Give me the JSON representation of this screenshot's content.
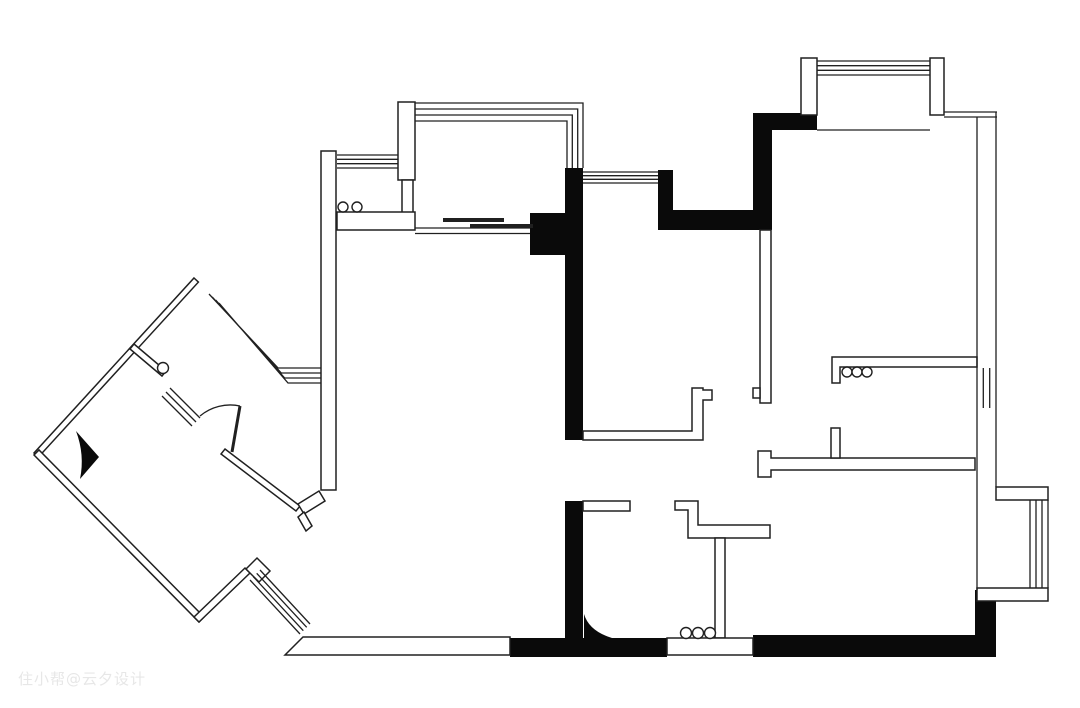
{
  "page": {
    "title": "apartment-floor-plan",
    "width": 1080,
    "height": 708,
    "background": "#ffffff"
  },
  "watermark": {
    "text": "住小帮@云夕设计",
    "color": "#e7e7e7"
  },
  "plan": {
    "stroke": "#202020",
    "fill_black": "#0a0a0a",
    "white": "#ffffff",
    "elements": [
      {
        "name": "black-wall-kitchen-column",
        "kind": "black",
        "d": "M565,168 H583 V440 H565 Z M530,213 H565 V255 H530 Z"
      },
      {
        "name": "black-wall-top-center",
        "kind": "black",
        "d": "M658,170 H673 V210 H753 V113 H817 V130 H772 V230 H658 Z"
      },
      {
        "name": "black-wall-bottom-left",
        "kind": "black",
        "d": "M565,501 H583 V638 H667 V657 H510 V638 H565 Z"
      },
      {
        "name": "black-wall-bottom-right",
        "kind": "black",
        "d": "M753,635 H975 V590 H996 V657 H753 Z"
      },
      {
        "name": "door-swing-bathroom",
        "kind": "black",
        "d": "M584,614 L584,638 L612,638 Q589,631 584,614 Z"
      },
      {
        "name": "door-swing-foyer",
        "kind": "black",
        "d": "M76,431 L99,457 L80,479 Q85,455 76,431 Z"
      },
      {
        "name": "wall-living-west",
        "kind": "wall",
        "x": 321,
        "y": 151,
        "w": 15,
        "h": 339
      },
      {
        "name": "pier-balcony",
        "kind": "wall",
        "x": 398,
        "y": 102,
        "w": 17,
        "h": 78
      },
      {
        "name": "wall-kitchen-divider",
        "kind": "wall",
        "x": 402,
        "y": 180,
        "w": 11,
        "h": 33
      },
      {
        "name": "counter-kitchen",
        "kind": "wall",
        "x": 337,
        "y": 212,
        "w": 78,
        "h": 18
      },
      {
        "name": "pier-bay-north-left",
        "kind": "wall",
        "x": 801,
        "y": 58,
        "w": 16,
        "h": 57
      },
      {
        "name": "pier-bay-north-right",
        "kind": "wall",
        "x": 930,
        "y": 58,
        "w": 14,
        "h": 57
      },
      {
        "name": "wall-bedroom1-south",
        "kind": "wall",
        "d": "M832,357 H977 V367 H840 V383 H832 Z"
      },
      {
        "name": "wall-hallway",
        "kind": "wall",
        "d": "M758,451 H771 V458 H975 V470 H771 V477 H758 Z"
      },
      {
        "name": "wall-hallway-stub",
        "kind": "wall",
        "x": 831,
        "y": 428,
        "w": 9,
        "h": 30
      },
      {
        "name": "wall-hall-center",
        "kind": "wall",
        "x": 760,
        "y": 230,
        "w": 11,
        "h": 173
      },
      {
        "name": "wall-hall-center-tab",
        "kind": "wall",
        "x": 753,
        "y": 388,
        "w": 7,
        "h": 10
      },
      {
        "name": "wall-dining-divider",
        "kind": "wall",
        "d": "M583,431 H692 V388 H703 V390 H712 V400 H703 V440 H583 Z"
      },
      {
        "name": "wall-bathroom-north",
        "kind": "wall",
        "x": 583,
        "y": 501,
        "w": 47,
        "h": 10
      },
      {
        "name": "wall-bathroom-step",
        "kind": "wall",
        "d": "M675,501 H698 V525 H770 V538 H688 V510 H675 Z"
      },
      {
        "name": "wall-bathroom-inner",
        "kind": "wall",
        "x": 715,
        "y": 538,
        "w": 10,
        "h": 100
      },
      {
        "name": "entry-threshold",
        "kind": "wall",
        "x": 667,
        "y": 638,
        "w": 86,
        "h": 17
      },
      {
        "name": "wall-bottom-south",
        "kind": "wall",
        "d": "M303,637 H510 V655 H285 Z"
      },
      {
        "name": "bay-right-top-band",
        "kind": "wall",
        "x": 996,
        "y": 487,
        "w": 52,
        "h": 13
      },
      {
        "name": "bay-right-bottom-band",
        "kind": "wall",
        "x": 977,
        "y": 588,
        "w": 71,
        "h": 13
      },
      {
        "name": "wall-foyer-northwest",
        "kind": "wall",
        "d": "M194,278 L198.4,282.1 L38.4,457.1 L34,453 Z"
      },
      {
        "name": "wall-foyer-branch",
        "kind": "wall",
        "d": "M134,344 L166,371 L162,376 L130,349 Z"
      },
      {
        "name": "wall-foyer-southwest",
        "kind": "wall",
        "d": "M34,455 L199,622 L204,617 L39,450 Z"
      },
      {
        "name": "wall-foyer-southeast",
        "kind": "wall",
        "d": "M199,622 L250,573 L245,568 L194,617 Z"
      },
      {
        "name": "wall-corridor-step",
        "kind": "wall",
        "d": "M246,569 L257,558 L270,571 L259,582 Z"
      },
      {
        "name": "wall-foyer-northeast",
        "kind": "wall",
        "d": "M225,449 L300,506 L296,511 L221,454 Z"
      },
      {
        "name": "wall-foyer-jog",
        "kind": "wall",
        "d": "M298,504 L319,491 L325,501 L304,514 Z"
      },
      {
        "name": "wall-foyer-jog-tab",
        "kind": "wall",
        "d": "M304,512 L312,526 L306,531 L298,517 Z"
      },
      {
        "name": "window-balcony-west",
        "kind": "line",
        "d": "M337,155 H398 M337,159.3 H398 M337,163.7 H398 M337,168 H398"
      },
      {
        "name": "window-balcony-north",
        "kind": "line",
        "d": "M415,103 H583 V168 M415,109 H577.7 V168 M415,115 H572.3 V168 M415,121 H567 V168"
      },
      {
        "name": "track-sliding-door",
        "kind": "line",
        "d": "M415,228 H530 M415,233.5 H530"
      },
      {
        "name": "window-kitchen-east",
        "kind": "line",
        "d": "M583,172 H658 M583,175.7 H658 M583,179.3 H658 M583,183 H658"
      },
      {
        "name": "window-bay-north",
        "kind": "line",
        "d": "M817,61 H930 M817,65.7 H930 M817,70.3 H930 M817,75 H930"
      },
      {
        "name": "sill-bay-north",
        "kind": "line",
        "d": "M817,130 H930"
      },
      {
        "name": "wall-bedroom1-north-east",
        "kind": "line",
        "d": "M944,112 H997 M944,117 H997"
      },
      {
        "name": "wall-bedroom1-east",
        "kind": "line",
        "d": "M977,117 V368 M996,112 V368"
      },
      {
        "name": "window-bedroom1-east",
        "kind": "line",
        "d": "M977,368 V408 M983.3,368 V408 M989.7,368 V408 M996,368 V408"
      },
      {
        "name": "wall-bedroom2-east",
        "kind": "line",
        "d": "M977,408 V590 M996,408 V487"
      },
      {
        "name": "window-bay-right",
        "kind": "line",
        "d": "M1030,500 V588 M1036,500 V588 M1042,500 V588 M1048,500 V588"
      },
      {
        "name": "window-foyer-upper",
        "kind": "line",
        "d": "M209,294 L278,368 H321 M212.3,297 L281.3,373 H321 M215.7,300 L284.7,378 H321 M219,303 L288,383 H321"
      },
      {
        "name": "window-foyer-lower",
        "kind": "line",
        "d": "M162,396 L192,426 M166,392 L196,422 M170,388 L200,418"
      },
      {
        "name": "door-arc-foyer",
        "kind": "line",
        "d": "M200,416 A47 47 0 0 1 240,406"
      },
      {
        "name": "window-corridor",
        "kind": "line",
        "d": "M250,580 L300,634 M253.3,576.7 L303.3,630.7 M256.7,573.3 L306.7,627.3 M260,570 L310,624"
      },
      {
        "name": "door-leaf-foyer",
        "kind": "bar",
        "d": "M232,452 L240,406",
        "sw": 3
      },
      {
        "name": "door-sliding-panel-left",
        "kind": "bar",
        "d": "M443,220 H504",
        "sw": 4
      },
      {
        "name": "door-sliding-panel-right",
        "kind": "bar",
        "d": "M470,226 H533",
        "sw": 4
      },
      {
        "name": "fixture-pipe-balcony-1",
        "kind": "circle",
        "cx": 343,
        "cy": 207,
        "r": 5
      },
      {
        "name": "fixture-pipe-balcony-2",
        "kind": "circle",
        "cx": 357,
        "cy": 207,
        "r": 5
      },
      {
        "name": "fixture-hook-bedroom1-1",
        "kind": "circle",
        "cx": 847,
        "cy": 372,
        "r": 5
      },
      {
        "name": "fixture-hook-bedroom1-2",
        "kind": "circle",
        "cx": 857,
        "cy": 372,
        "r": 5
      },
      {
        "name": "fixture-hook-bedroom1-3",
        "kind": "circle",
        "cx": 867,
        "cy": 372,
        "r": 5
      },
      {
        "name": "fixture-entry-circle-1",
        "kind": "circle",
        "cx": 686,
        "cy": 633,
        "r": 5.5
      },
      {
        "name": "fixture-entry-circle-2",
        "kind": "circle",
        "cx": 698,
        "cy": 633,
        "r": 5.5
      },
      {
        "name": "fixture-entry-circle-3",
        "kind": "circle",
        "cx": 710,
        "cy": 633,
        "r": 5.5
      },
      {
        "name": "fixture-foyer-circle",
        "kind": "circle",
        "cx": 163,
        "cy": 368,
        "r": 5.5
      }
    ]
  }
}
